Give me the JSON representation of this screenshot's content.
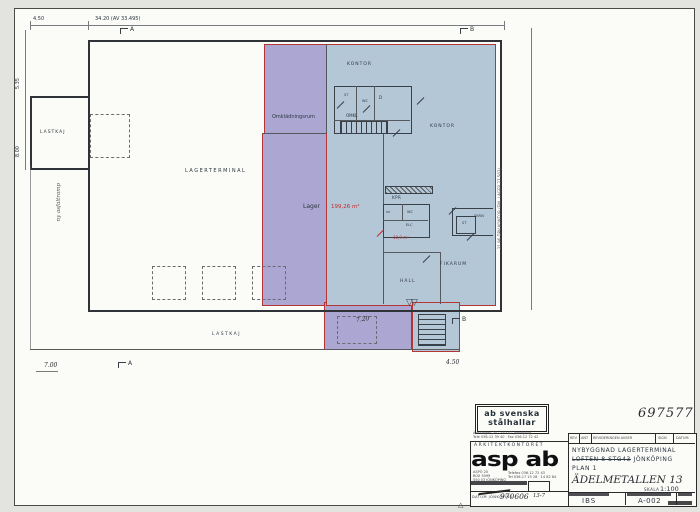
{
  "plan": {
    "rooms": {
      "lagerterminal": "LAGERTERMINAL",
      "lastkaj_left": "LASTKAJ",
      "lastkaj_bottom": "LASTKAJ",
      "omkladningsrum": "Omklädningsrum",
      "lager": "Lager",
      "lager_area": "199,26 m²",
      "kontor_top": "KONTOR",
      "kontor_right": "KONTOR",
      "omkl": "OMKL",
      "st1": "ST",
      "wc1": "WC",
      "d1": "D",
      "kpr": "KPR",
      "hk": "HK",
      "wc2": "WC",
      "elc": "ELC",
      "area_note": "10,9 m²",
      "st2": "ST",
      "skriv": "SKRIV",
      "fikarum": "FIKARUM",
      "hall": "HALL"
    },
    "dims": {
      "top_left": "4.50",
      "top_main": "34.20 (AV 33.495)",
      "left_upper": "5.35",
      "left_lower": "8.00",
      "bottom_left": "7.00",
      "bottom_right": "4.50",
      "protrusion": "7.20",
      "right_note": "21.96 ÖPV KONTOR (ENL LAGER 27.563)"
    },
    "markers": {
      "a_top": "A",
      "b_top": "B",
      "a_bottom": "A",
      "b_bottom": "B"
    },
    "notes": {
      "ramp": "ny asfaltramp"
    },
    "glyphs": {
      "double_door": "▽▽",
      "rev_triangle": "△"
    }
  },
  "titleblock": {
    "stamp_number": "697577",
    "logo1": "ab svenska",
    "logo2": "stålhallar",
    "logo_addr1": "Ädelvägen 20 · 553 02 Jönköping",
    "logo_addr2": "Tele 036-12 39 40 · Fax 036-12 72 42",
    "arch": "ARKITEKTKONTORET",
    "asp": "asp ab",
    "addr1a": "ASPÖ 20",
    "addr1b": "BOX 3099",
    "addr1c": "550 03 JÖNKÖPING",
    "addr2a": "Telefax 036-12 72 43",
    "addr2b": "Tel 036-17 15 28 · 14 82 84",
    "check_no": "13-7",
    "datum_label": "DATUM JÖNKÖPING",
    "datum_value": "970606",
    "rev_headers": {
      "rev": "REV",
      "ant": "ANT",
      "avser": "REVIDERINGEN AVSER",
      "sign": "SIGN",
      "datum": "DATUM"
    },
    "title1": "NYBYGGNAD LAGERTERMINAL",
    "title2_struck": "LOFTEN 8 STG43",
    "title2_rest": "JÖNKÖPING",
    "title3": "PLAN 1",
    "property": "ÄDELMETALLEN 13",
    "skala_label": "SKALA",
    "skala_value": "1:100",
    "handl": "IBS",
    "drawing_id": "A-002"
  }
}
